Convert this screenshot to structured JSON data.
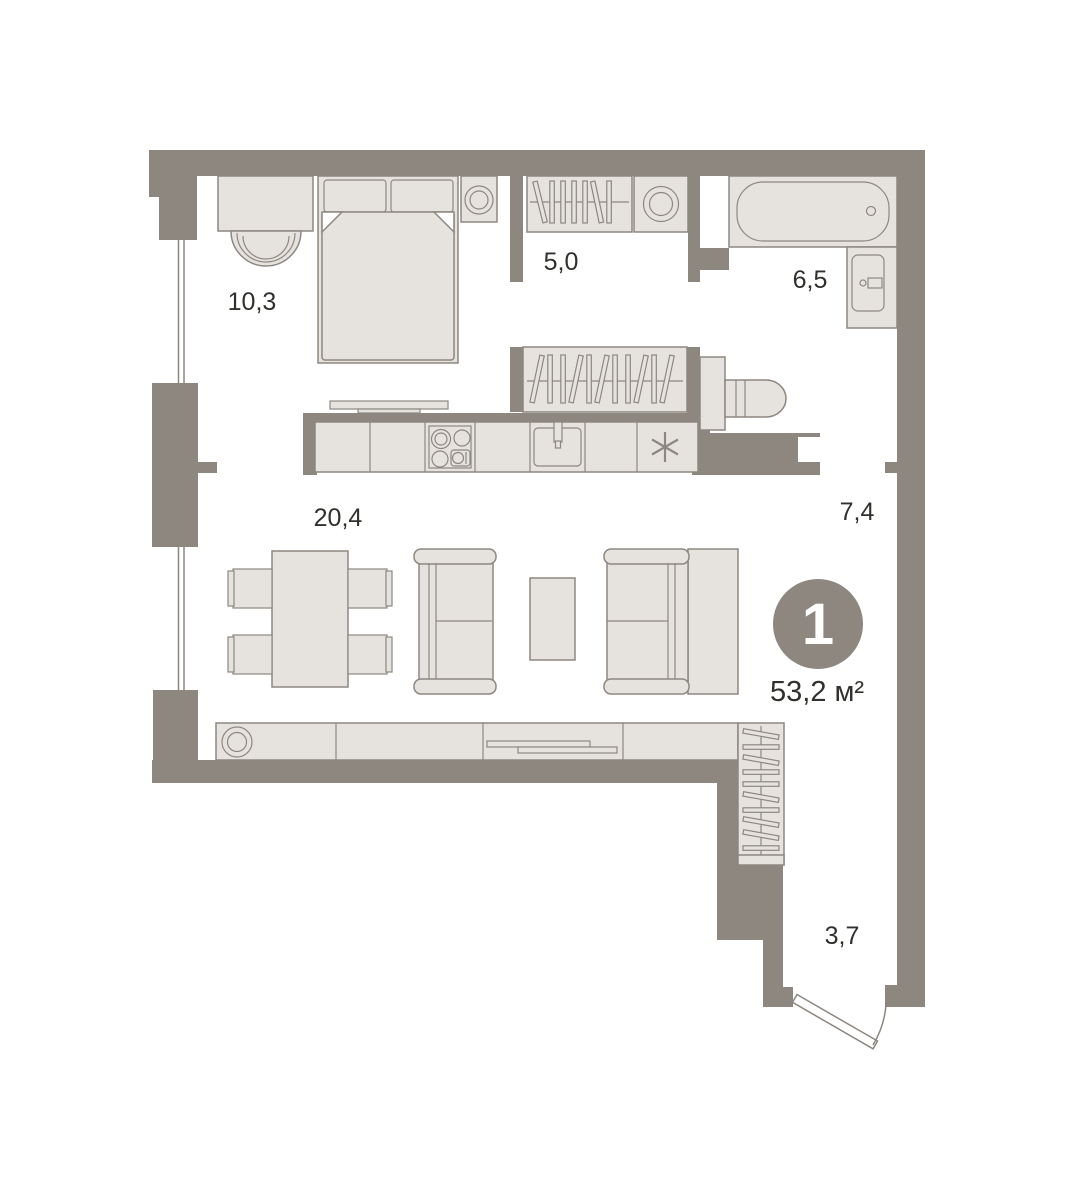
{
  "colors": {
    "wall": "#8D8780",
    "furniture": "#E6E3DE",
    "outline": "#8D8780",
    "label_text": "#32302C",
    "badge_text": "#FFFFFF",
    "background": "#FFFFFF"
  },
  "badge": {
    "rooms_count": "1",
    "total_area": "53,2 м²"
  },
  "rooms": [
    {
      "name": "bedroom",
      "area": "10,3"
    },
    {
      "name": "wardrobe",
      "area": "5,0"
    },
    {
      "name": "bathroom",
      "area": "6,5"
    },
    {
      "name": "hallway",
      "area": "7,4"
    },
    {
      "name": "living-kitchen",
      "area": "20,4"
    },
    {
      "name": "entry",
      "area": "3,7"
    }
  ]
}
